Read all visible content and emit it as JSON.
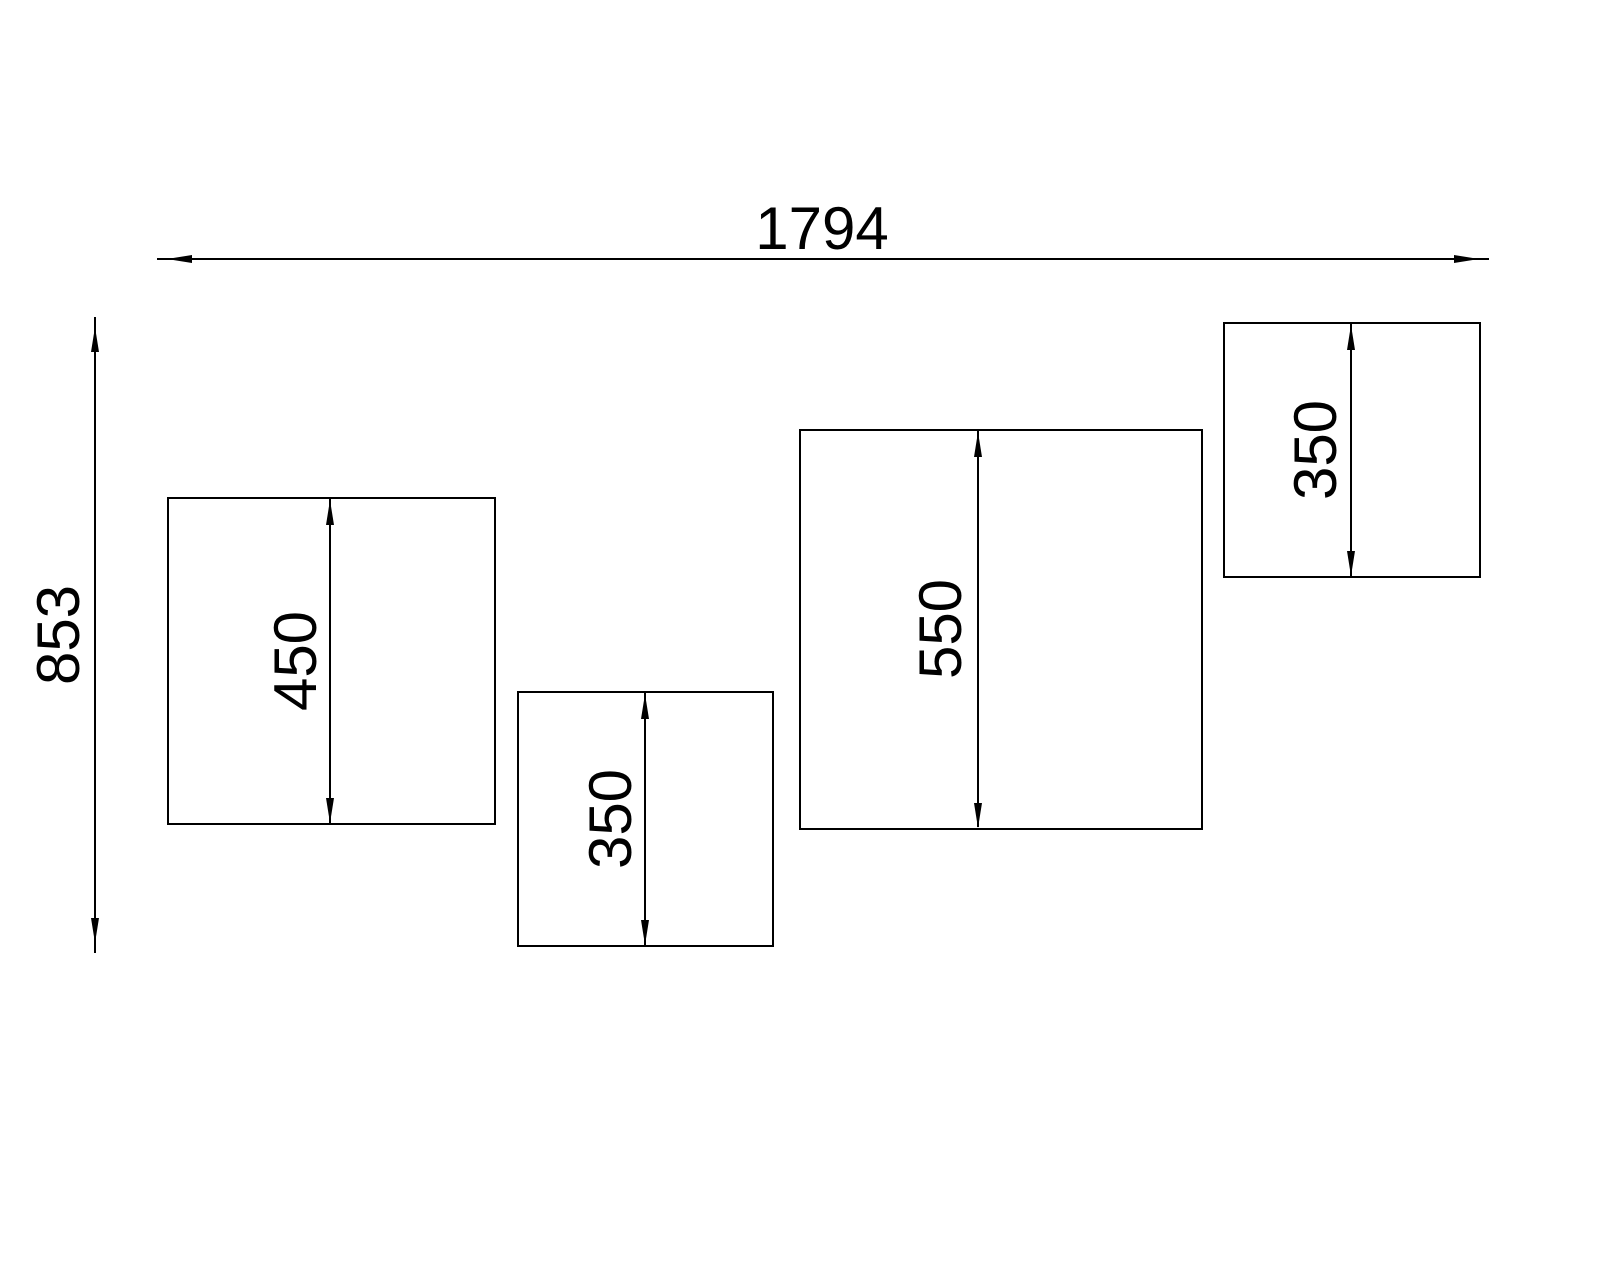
{
  "colors": {
    "background": "#ffffff",
    "line": "#000000",
    "text": "#000000"
  },
  "overall": {
    "width_label": "1794",
    "height_label": "853"
  },
  "panels": [
    {
      "height_label": "450"
    },
    {
      "height_label": "350"
    },
    {
      "height_label": "550"
    },
    {
      "height_label": "350"
    }
  ]
}
